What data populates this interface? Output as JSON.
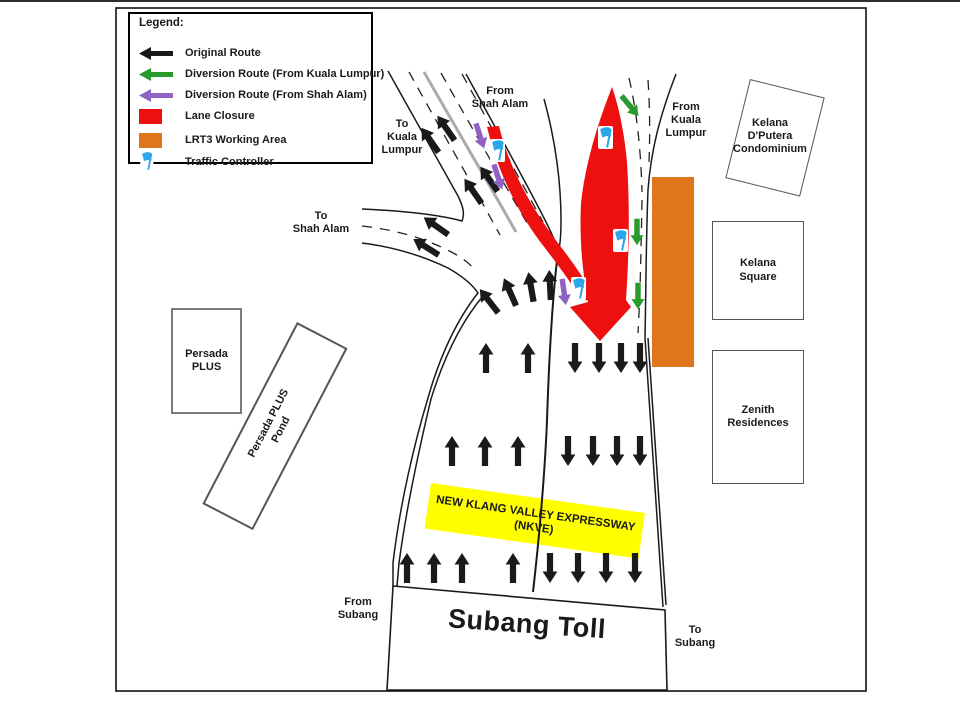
{
  "legend": {
    "title": "Legend:",
    "items": [
      {
        "name": "original-route",
        "label": "Original Route",
        "color": "#1a1a1a"
      },
      {
        "name": "diversion-from-kuala-lumpur",
        "label": "Diversion Route (From Kuala Lumpur)",
        "color": "#289b2c"
      },
      {
        "name": "diversion-from-shah-alam",
        "label": "Diversion Route (From Shah Alam)",
        "color": "#9062c3"
      },
      {
        "name": "lane-closure",
        "label": "Lane Closure",
        "color": "#ee0f0f"
      },
      {
        "name": "lrt3-working-area",
        "label": "LRT3 Working Area",
        "color": "#e0761c"
      },
      {
        "name": "traffic-controller",
        "label": "Traffic Controller",
        "color": "#2ba6e8"
      }
    ]
  },
  "labels": {
    "from_shah_alam": "From\nShah Alam",
    "to_kuala_lumpur": "To\nKuala\nLumpur",
    "from_kuala_lumpur": "From\nKuala\nLumpur",
    "to_shah_alam": "To\nShah Alam",
    "from_subang": "From\nSubang",
    "to_subang": "To\nSubang",
    "subang_toll": "Subang Toll",
    "nkve": "NEW KLANG VALLEY EXPRESSWAY\n(NKVE)"
  },
  "buildings": {
    "persada_plus": "Persada\nPLUS",
    "persada_plus_pond": "Persada PLUS\nPond",
    "kelana_dputera": "Kelana\nD'Putera\nCondominium",
    "kelana_square": "Kelana\nSquare",
    "zenith_residences": "Zenith\nResidences"
  },
  "colors": {
    "original_route": "#1a1a1a",
    "diversion_from_kl": "#289b2c",
    "diversion_from_sa": "#9062c3",
    "lane_closure": "#ee0f0f",
    "lrt3_area": "#e0761c",
    "traffic_controller": "#2ba6e8",
    "nkve_highlight": "#ffff00",
    "road_line": "#1a1a1a"
  }
}
